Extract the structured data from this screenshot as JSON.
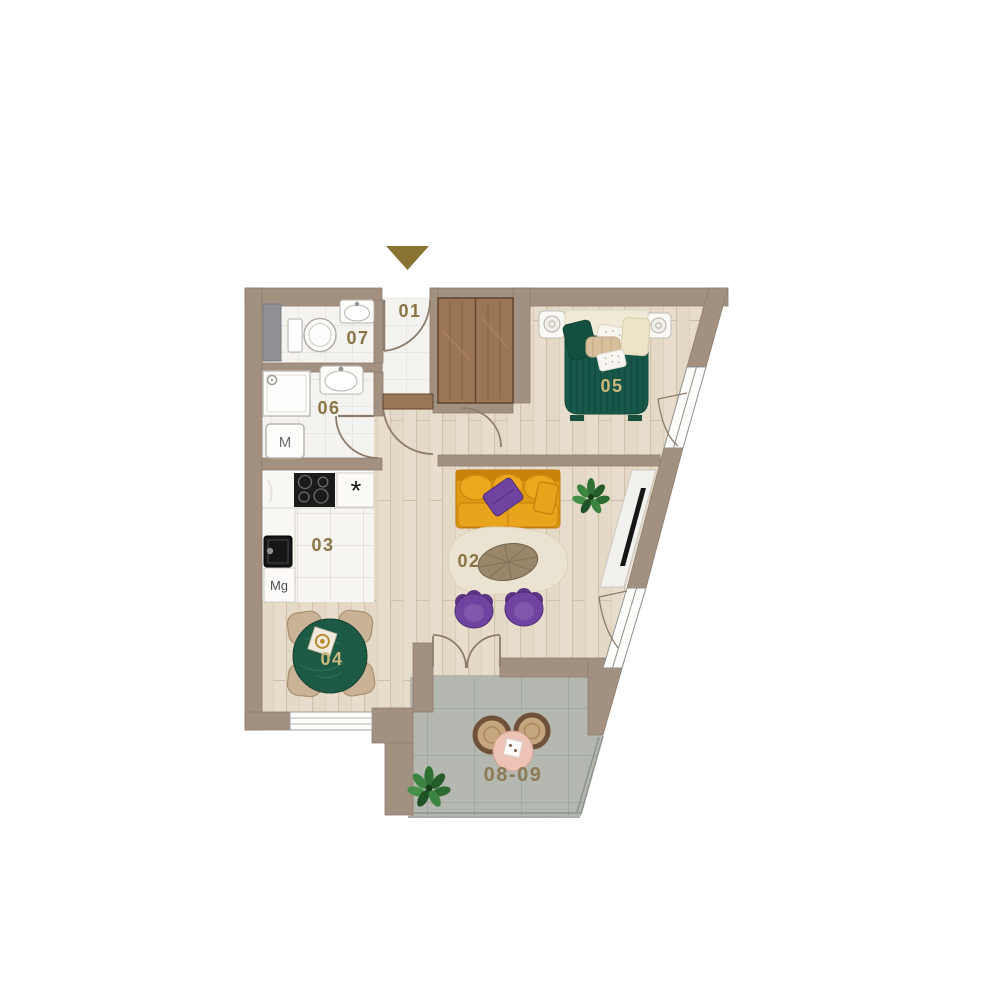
{
  "floor_plan": {
    "compass_arrow": {
      "direction": "down",
      "color": "#8a7434"
    },
    "room_labels": {
      "r01": "01",
      "r02": "02",
      "r03": "03",
      "r04": "04",
      "r05": "05",
      "r06": "06",
      "r07": "07",
      "r08_09": "08-09"
    },
    "appliance_labels": {
      "washing_machine": "M",
      "kitchen_mg": "Mg",
      "kitchen_star": "*"
    },
    "colors": {
      "wall": "#a29181",
      "wood_floor": "#e4d9c7",
      "bathroom_tile": "#f4f3f0",
      "balcony_tile": "#b4b8b1",
      "bed_duvet": "#17584a",
      "sofa": "#e8a41c",
      "armchair_purple": "#6f44a0",
      "dining_table": "#1d5a45",
      "label_dark": "#8a7444",
      "label_light": "#cdb87e",
      "arrow": "#8a7434"
    }
  }
}
